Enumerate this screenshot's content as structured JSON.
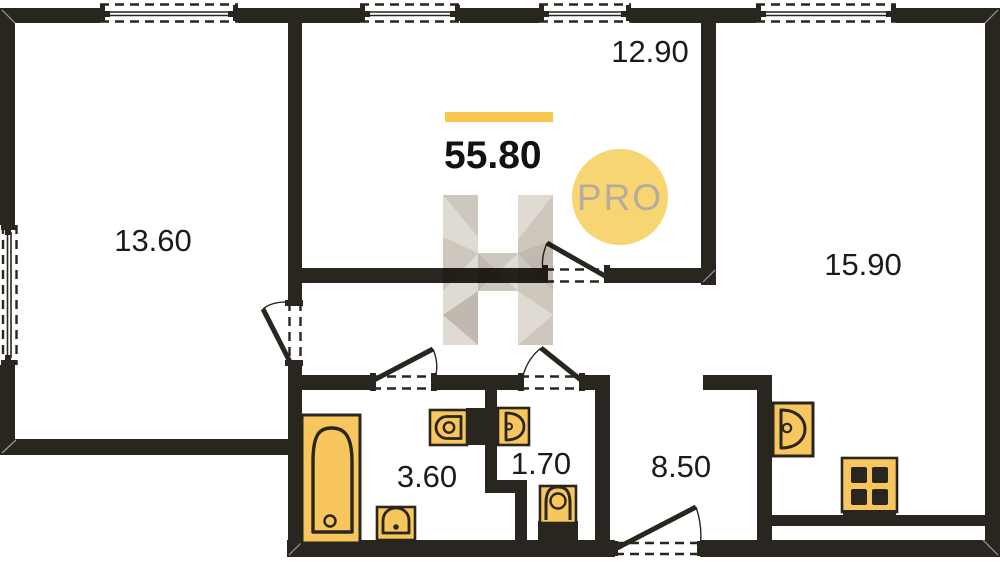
{
  "plan": {
    "total": {
      "area": "55.80"
    },
    "badge": {
      "label": "PRO"
    },
    "watermark": {
      "letter": "H"
    },
    "rooms": [
      {
        "label": "12.90"
      },
      {
        "label": "13.60"
      },
      {
        "label": "15.90"
      },
      {
        "label": "3.60"
      },
      {
        "label": "1.70"
      },
      {
        "label": "8.50"
      }
    ],
    "fixtures": [
      "bathtub",
      "washbasin",
      "sink",
      "toilet",
      "shower",
      "kitchen-sink",
      "stove"
    ],
    "counts": {
      "windows": 5,
      "doors": 5
    },
    "colors": {
      "wall": "#29251f",
      "accent": "#f7c65d",
      "accent_bar": "#fbc84f",
      "badge_bg": "#f8d573",
      "badge_text": "#b5ac9d",
      "label": "#1b1b1b",
      "wm_light": "#dcd6cd",
      "wm_mid": "#c8c1b6",
      "wm_dark": "#b9b1a6"
    }
  }
}
